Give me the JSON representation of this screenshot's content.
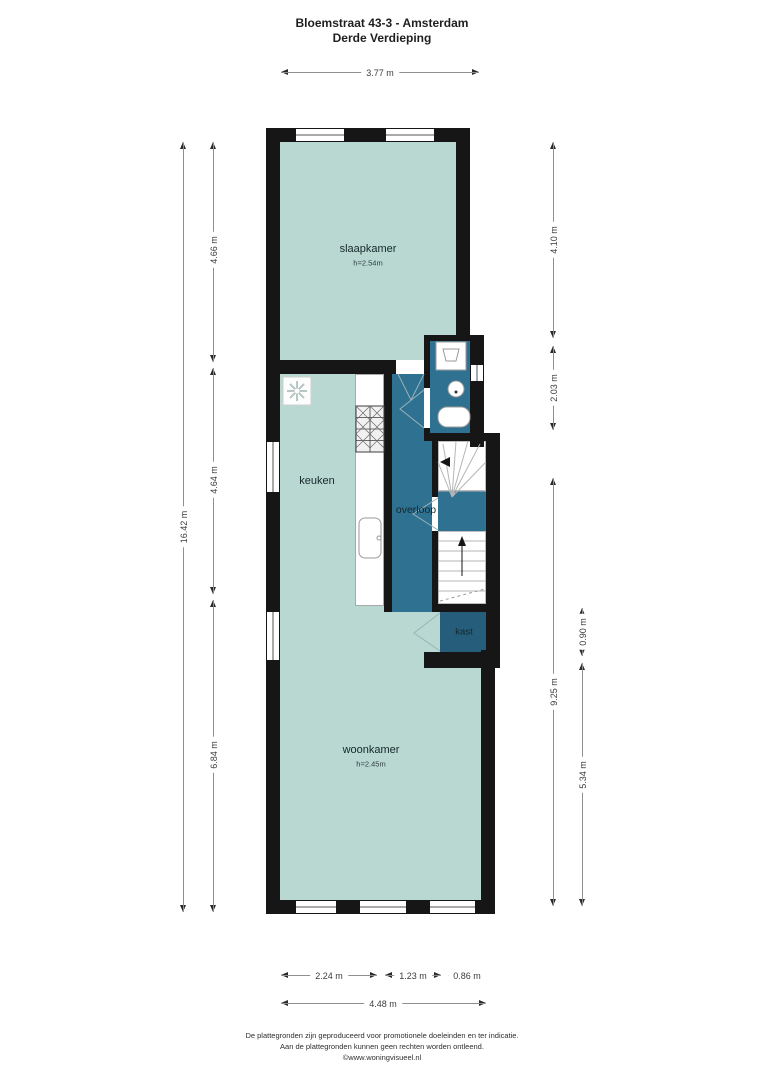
{
  "title": {
    "line1": "Bloemstraat 43-3 - Amsterdam",
    "line2": "Derde Verdieping"
  },
  "rooms": {
    "slaapkamer": {
      "name": "slaapkamer",
      "height_label": "h=2.54m"
    },
    "keuken": {
      "name": "keuken"
    },
    "overloop": {
      "name": "overloop"
    },
    "kast": {
      "name": "kast"
    },
    "woonkamer": {
      "name": "woonkamer",
      "height_label": "h=2.45m"
    }
  },
  "dimensions": {
    "top": "3.77 m",
    "left_total": "16.42 m",
    "left_segments": [
      "4.66 m",
      "4.64 m",
      "6.84 m"
    ],
    "right_inner": [
      "4.10 m",
      "2.03 m",
      "9.25 m"
    ],
    "right_outer": [
      "0.90 m",
      "5.34 m"
    ],
    "bottom_segments": [
      "2.24 m",
      "1.23 m",
      "0.86 m"
    ],
    "bottom_total": "4.48 m"
  },
  "footer": {
    "line1": "De plattegronden zijn geproduceerd voor promotionele doeleinden en ter indicatie.",
    "line2": "Aan de plattegronden kunnen geen rechten worden ontleend.",
    "line3": "©www.woningvisueel.nl"
  },
  "colors": {
    "room_fill": "#b9d8d1",
    "hall_fill": "#2e7191",
    "closet_fill": "#255d7a",
    "wall": "#161616"
  }
}
